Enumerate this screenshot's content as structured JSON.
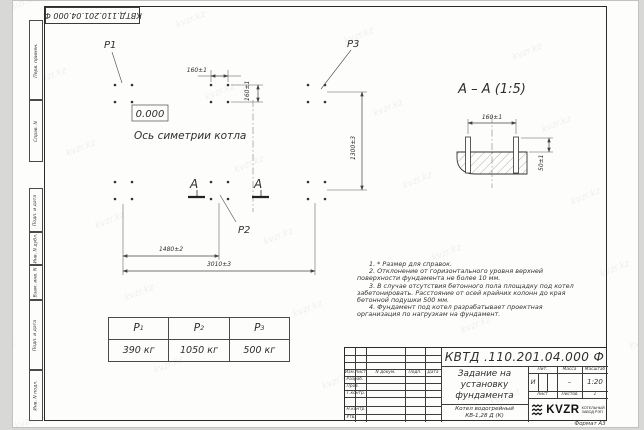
{
  "page": {
    "format_note": "Формат А3",
    "watermark": "kvzr.kz"
  },
  "top_stamp": {
    "text": "КВТД.110.201.04.000  Ф"
  },
  "margin_fields": [
    "Перв. примен.",
    "Справ. N",
    "Подп. и дата",
    "Инв. N дубл.",
    "Взам. инв. N",
    "Подп. и дата",
    "Инв. N подл."
  ],
  "plan": {
    "p1": "P1",
    "p2": "P2",
    "p3": "P3",
    "elevation": "0.000",
    "axis_label": "Ось симетрии котла",
    "section_letter": "А",
    "dim_160_h": "160±1",
    "dim_160_v": "160±1",
    "dim_1300": "1300±3",
    "dim_1480": "1480±2",
    "dim_3010": "3010±3"
  },
  "section_view": {
    "title": "А – А (1:5)",
    "dim_160": "160±1",
    "dim_50": "50±1"
  },
  "notes": [
    "1. * Размер для справок.",
    "2. Отклонение от горизонтального уровня верхней поверхности фундамента не более 10 мм.",
    "3. В случае отсутствия бетонного пола площадку под котел забетонировать. Расстояние от осей крайних колонн до края бетонной подушки 500 мм.",
    "4. Фундамент под котел разрабатывает проектная организация по нагрузкам на фундамент."
  ],
  "load_table": {
    "columns": [
      {
        "name": "P",
        "sub": "1",
        "value": "390 кг"
      },
      {
        "name": "P",
        "sub": "2",
        "value": "1050 кг"
      },
      {
        "name": "P",
        "sub": "3",
        "value": "500 кг"
      }
    ]
  },
  "title_block": {
    "designation": "КВТД .110.201.04.000  Ф",
    "title_lines": [
      "Задание на",
      "установку",
      "фундамента"
    ],
    "product_lines": [
      "Котел водогрейный",
      "КВ-1,28 Д (К)"
    ],
    "cols": {
      "izm": "Изм.",
      "list": "Лист",
      "doc": "N докум.",
      "podp": "Подп.",
      "data": "Дата"
    },
    "rows": [
      "Разраб.",
      "Пров.",
      "Т.контр.",
      "Н.контр.",
      "Утв."
    ],
    "lit_label": "Лит.",
    "lit_value": "И",
    "mass_label": "Масса",
    "mass_value": "–",
    "scale_label": "Масштаб",
    "scale_value": "1:20",
    "sheet_label": "Лист",
    "sheets_label": "Листов",
    "sheets_value": "1",
    "logo_text": "KVZR",
    "logo_caption_lines": [
      "КОТЕЛЬНЫЙ",
      "ЗАВОД РЭП"
    ]
  }
}
